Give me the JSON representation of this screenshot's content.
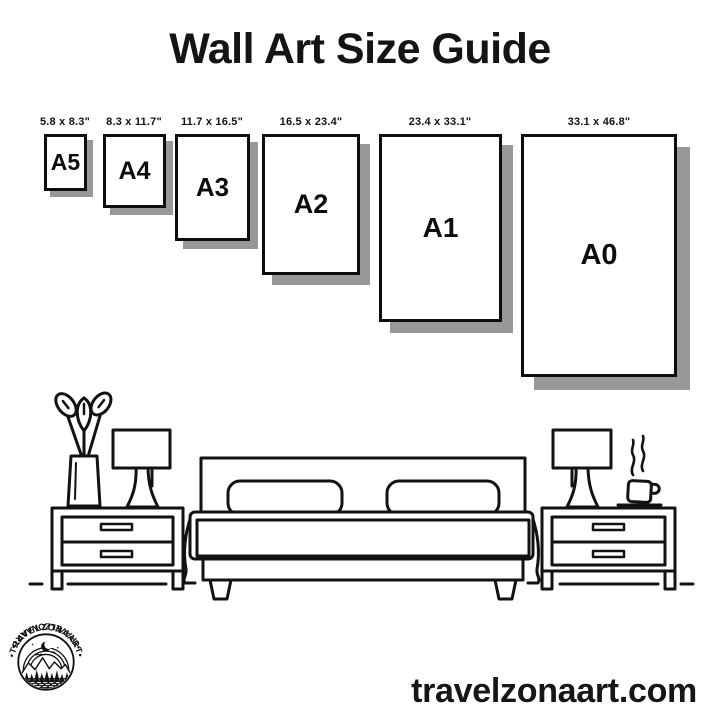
{
  "title": "Wall Art Size Guide",
  "frames": [
    {
      "name": "A5",
      "size": "5.8 x 8.3\""
    },
    {
      "name": "A4",
      "size": "8.3 x 11.7\""
    },
    {
      "name": "A3",
      "size": "11.7 x 16.5\""
    },
    {
      "name": "A2",
      "size": "16.5 x 23.4\""
    },
    {
      "name": "A1",
      "size": "23.4 x 33.1\""
    },
    {
      "name": "A0",
      "size": "33.1 x 46.8\""
    }
  ],
  "footer": {
    "website": "travelzonaart.com"
  },
  "logo": {
    "text_top": "•TRAVELZONAART•",
    "text_bottom": "•TRAVELZONAART•"
  },
  "colors": {
    "ink": "#121212",
    "shadow": "#989898",
    "background": "#ffffff"
  }
}
